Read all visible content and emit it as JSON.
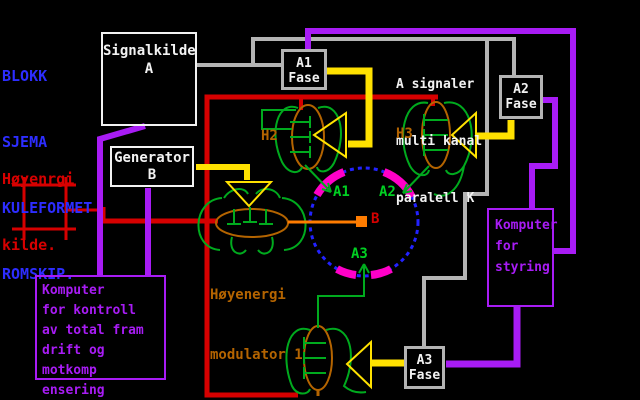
{
  "colors": {
    "blue": "#2d2dff",
    "red": "#d60000",
    "white": "#f2f2f2",
    "gray": "#b4b4b4",
    "yellow": "#ffe100",
    "purple": "#a81cf5",
    "magenta": "#ff00c8",
    "green": "#00aa1e",
    "greenBright": "#00d022",
    "brown": "#b46400",
    "orange": "#ff7c00",
    "circleBlue": "#2222ff"
  },
  "title": {
    "lines": [
      "BLOKK",
      "SJEMA",
      "KULEFORMET",
      "ROMSKIP."
    ]
  },
  "energy_source": {
    "lines": [
      "Høyenrgi",
      "kilde."
    ]
  },
  "boxes": {
    "signal_source": {
      "lines": [
        "Signalkilde",
        "A"
      ]
    },
    "generator": {
      "lines": [
        "Generator",
        "B"
      ]
    },
    "phase_a1": {
      "lines": [
        "A1",
        "Fase"
      ]
    },
    "phase_a2": {
      "lines": [
        "A2",
        "Fase"
      ]
    },
    "phase_a3": {
      "lines": [
        "A3",
        "Fase"
      ]
    },
    "computer_steering": {
      "lines": [
        "Komputer",
        "for",
        "styring"
      ]
    },
    "computer_control": {
      "lines": [
        "Komputer",
        "for kontroll",
        "av total fram",
        "drift og motkomp",
        "ensering"
      ]
    }
  },
  "notes": {
    "signals": {
      "lines": [
        "A signaler",
        "multi kanal",
        "paralell K"
      ]
    },
    "modulator": {
      "lines": [
        "Høyenergi",
        "modulator 1"
      ]
    }
  },
  "labels": {
    "h2": "H2",
    "h3": "H3",
    "a1": "A1",
    "a2": "A2",
    "a3": "A3",
    "b": "B"
  }
}
